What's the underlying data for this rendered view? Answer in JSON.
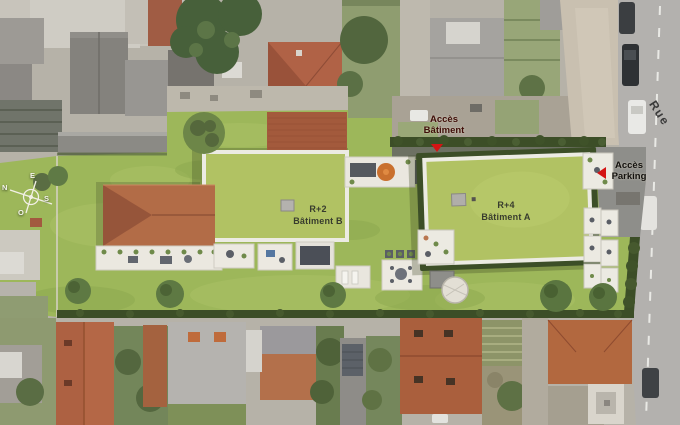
{
  "plan_labels": {
    "building_a": {
      "line1": "R+4",
      "line2": "Bâtiment A"
    },
    "building_b": {
      "line1": "R+2",
      "line2": "Bâtiment B"
    },
    "access_building": {
      "line1": "Accès",
      "line2": "Bâtiment"
    },
    "access_parking": {
      "line1": "Accès",
      "line2": "Parking"
    },
    "street_name_fragment": "Rue"
  },
  "compass": {
    "north": "N",
    "south": "S",
    "east": "E",
    "west": "O"
  },
  "colors": {
    "site_green": "#9db75a",
    "building_roof_green": "#b1c263",
    "hedge_dark": "#3c4e27",
    "terracotta_roof": "#b26c47",
    "tile_roof_north": "#a35a3c",
    "accent_red": "#d41414",
    "street_gray": "#b3b1ae"
  }
}
